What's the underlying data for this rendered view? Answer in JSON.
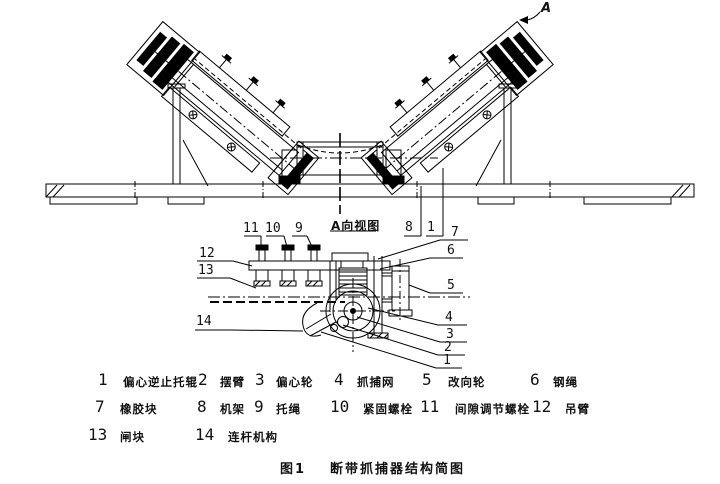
{
  "figure": {
    "label": "图1",
    "title": "断带抓捕器结构简图"
  },
  "view_a": {
    "label": "A向视图",
    "direction_letter": "A"
  },
  "callouts": {
    "c11": "11",
    "c10": "10",
    "c9": "9",
    "c8": "8",
    "c1_top": "1",
    "c7": "7",
    "c6": "6",
    "c5": "5",
    "c4": "4",
    "c3": "3",
    "c2": "2",
    "c1_right": "1",
    "c12": "12",
    "c13": "13",
    "c14": "14"
  },
  "legend": {
    "items": [
      {
        "num": "1",
        "name": "偏心逆止托辊"
      },
      {
        "num": "2",
        "name": "摆臂"
      },
      {
        "num": "3",
        "name": "偏心轮"
      },
      {
        "num": "4",
        "name": "抓捕网"
      },
      {
        "num": "5",
        "name": "改向轮"
      },
      {
        "num": "6",
        "name": "钢绳"
      },
      {
        "num": "7",
        "name": "橡胶块"
      },
      {
        "num": "8",
        "name": "机架"
      },
      {
        "num": "9",
        "name": "托绳"
      },
      {
        "num": "10",
        "name": "紧固螺栓"
      },
      {
        "num": "11",
        "name": "间隙调节螺栓"
      },
      {
        "num": "12",
        "name": "吊臂"
      },
      {
        "num": "13",
        "name": "闸块"
      },
      {
        "num": "14",
        "name": "连杆机构"
      }
    ]
  }
}
